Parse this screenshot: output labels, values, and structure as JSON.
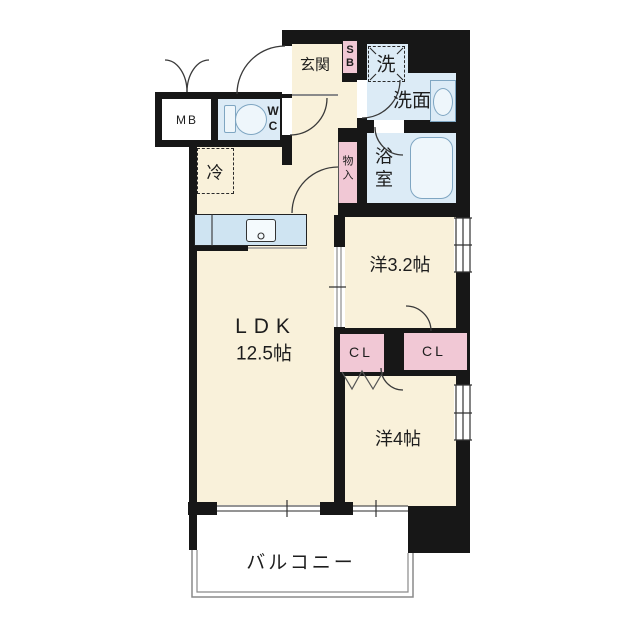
{
  "title": "apartment-floor-plan",
  "colors": {
    "wall": "#171717",
    "cream": "#f9f1da",
    "wet": "#dcebf6",
    "pink": "#f1c8d5",
    "counter": "#cfe4f2",
    "fixture": "#7fa6c2",
    "gray": "#8a8a8a"
  },
  "labels": {
    "genkan": "玄関",
    "sb_1": "S",
    "sb_2": "B",
    "washer": "洗",
    "senmen": "洗面",
    "bath_1": "浴",
    "bath_2": "室",
    "mono_1": "物",
    "mono_2": "入",
    "wc_1": "W",
    "wc_2": "C",
    "mb": "MB",
    "fridge": "冷",
    "ldk_name": "LDK",
    "ldk_size": "12.5帖",
    "yo32": "洋3.2帖",
    "cl_left": "CL",
    "cl_right": "CL",
    "yo4": "洋4帖",
    "balcony": "バルコニー"
  }
}
